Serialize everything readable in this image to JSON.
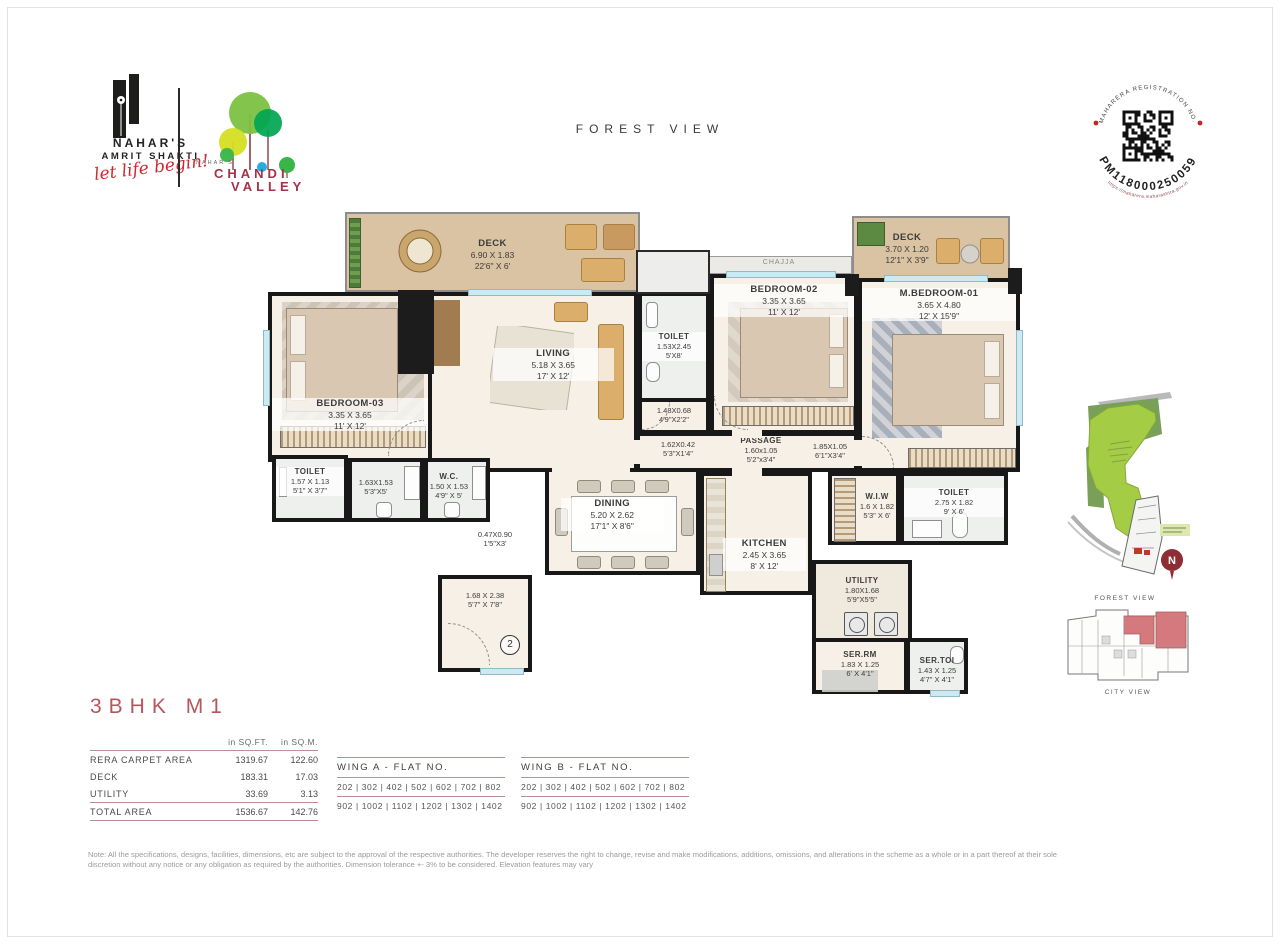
{
  "brand": {
    "name_line1": "NAHAR'S",
    "name_line2": "AMRIT SHAKTI",
    "tagline": "let life begin!",
    "chandi_pre": "NAHAR'S",
    "chandi_line1": "CHANDI",
    "chandi_line2": "VALLEY"
  },
  "header": {
    "view_label": "FOREST VIEW"
  },
  "rera": {
    "label": "MAHARERA REGISTRATION NO.",
    "number": "PM118000250059",
    "url": "https://maharera.maharashtra.gov.in"
  },
  "rooms": {
    "deck1": {
      "name": "DECK",
      "met": "6.90 X 1.83",
      "imp": "22'6\" X 6'"
    },
    "deck2": {
      "name": "DECK",
      "met": "3.70 X 1.20",
      "imp": "12'1\" X 3'9\""
    },
    "chajja": {
      "name": "CHAJJA"
    },
    "bedroom3": {
      "name": "BEDROOM-03",
      "met": "3.35 X 3.65",
      "imp": "11' X 12'"
    },
    "living": {
      "name": "LIVING",
      "met": "5.18 X 3.65",
      "imp": "17' X 12'"
    },
    "toilet_mid": {
      "name": "TOILET",
      "met": "1.53X2.45",
      "imp": "5'X8'"
    },
    "lobby148": {
      "met": "1.48X0.68",
      "imp": "4'9\"X2'2\""
    },
    "bedroom2": {
      "name": "BEDROOM-02",
      "met": "3.35 X 3.65",
      "imp": "11' X 12'"
    },
    "mbedroom1": {
      "name": "M.BEDROOM-01",
      "met": "3.65 X 4.80",
      "imp": "12' X 15'9\""
    },
    "p162": {
      "met": "1.62X0.42",
      "imp": "5'3\"X1'4\""
    },
    "passage": {
      "name": "PASSAGE",
      "met": "1.60x1.05",
      "imp": "5'2\"x3'4\""
    },
    "p185": {
      "met": "1.85X1.05",
      "imp": "6'1\"X3'4\""
    },
    "toilet_left": {
      "name": "TOILET",
      "met": "1.57 X 1.13",
      "imp": "5'1\" X 3'7\""
    },
    "bath163": {
      "met": "1.63X1.53",
      "imp": "5'3\"X5'"
    },
    "wc": {
      "name": "W.C.",
      "met": "1.50 X 1.53",
      "imp": "4'9\" X 5'"
    },
    "p047": {
      "met": "0.47X0.90",
      "imp": "1'5\"X3'"
    },
    "dining": {
      "name": "DINING",
      "met": "5.20 X 2.62",
      "imp": "17'1\" X 8'6\""
    },
    "kitchen": {
      "name": "KITCHEN",
      "met": "2.45 X 3.65",
      "imp": "8' X 12'"
    },
    "wiw": {
      "name": "W.I.W",
      "met": "1.6 X 1.82",
      "imp": "5'3\" X 6'"
    },
    "toilet_right": {
      "name": "TOILET",
      "met": "2.75 X 1.82",
      "imp": "9' X 6'"
    },
    "foyer": {
      "met": "1.68 X 2.38",
      "imp": "5'7\" X 7'8\""
    },
    "utility": {
      "name": "UTILITY",
      "met": "1.80X1.68",
      "imp": "5'9\"X5'5\""
    },
    "serrm": {
      "name": "SER.RM",
      "met": "1.83 X 1.25",
      "imp": "6' X 4'1\""
    },
    "sertoi": {
      "name": "SER.TOI",
      "met": "1.43 X 1.25",
      "imp": "4'7\" X 4'1\""
    },
    "entrance_badge": "2"
  },
  "unit": {
    "title": "3BHK M1",
    "table": {
      "col1": "in SQ.FT.",
      "col2": "in SQ.M.",
      "rows": [
        {
          "label": "RERA CARPET AREA",
          "sqft": "1319.67",
          "sqm": "122.60"
        },
        {
          "label": "DECK",
          "sqft": "183.31",
          "sqm": "17.03"
        },
        {
          "label": "UTILITY",
          "sqft": "33.69",
          "sqm": "3.13"
        }
      ],
      "total": {
        "label": "TOTAL AREA",
        "sqft": "1536.67",
        "sqm": "142.76"
      }
    }
  },
  "wings": {
    "wing_a": {
      "title": "WING A - FLAT NO.",
      "line1": "202 | 302 | 402 | 502 | 602 | 702 | 802",
      "line2": "902 | 1002 | 1102 | 1202 | 1302 | 1402"
    },
    "wing_b": {
      "title": "WING B - FLAT NO.",
      "line1": "202 | 302 | 402 | 502 | 602 | 702 | 802",
      "line2": "902 | 1002 | 1102 | 1202 | 1302 | 1402"
    }
  },
  "sitemap": {
    "caption_top": "FOREST VIEW",
    "caption_bottom": "CITY VIEW",
    "compass": "N"
  },
  "note": {
    "line1": "Note: All the specifications, designs, facilities, dimensions, etc are subject to the approval of the respective authorities. The developer reserves the right to change, revise and make modifications, additions, omissions, and alterations in the scheme as a whole or in a part thereof at their sole",
    "line2": "discretion without any notice or any obligation as required by the authorities. Dimension tolerance +- 3% to be considered. Elevation features may vary"
  },
  "colors": {
    "accent_red": "#b5565c",
    "rule_maroon": "#b98f8f",
    "brand_red": "#d22630",
    "chandi_maroon": "#a3324a",
    "green_bright": "#a4cc44",
    "green_dark": "#79a058",
    "keyplan_highlight": "#d47a7e"
  }
}
